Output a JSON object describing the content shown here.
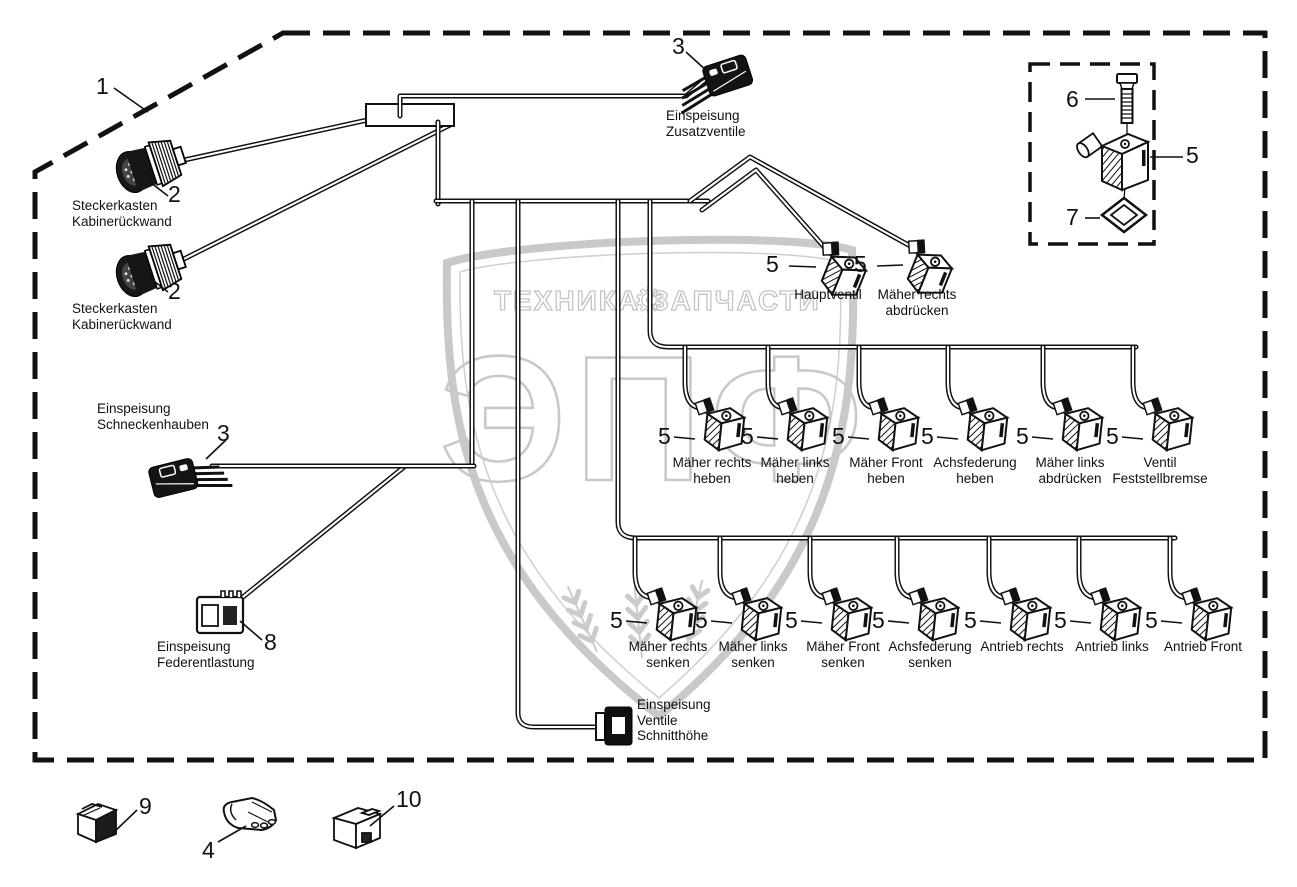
{
  "watermark": {
    "brand_left": "ТЕХНИКА",
    "brand_right": "ЗАПЧАСТИ",
    "gear_icon": "⚙",
    "monogram": "ЭПФ",
    "color": "#c9c9c9"
  },
  "callouts": {
    "harness": "1",
    "steckerkasten_a": "2",
    "steckerkasten_b": "2",
    "zusatzventile": "3",
    "schneckenhauben": "3",
    "part4": "4",
    "hauptventil": "5",
    "maeher_rechts_abdruecken": "5",
    "kit_screw": "6",
    "kit_valve": "5",
    "kit_seal": "7",
    "federentlastung": "8",
    "part9": "9",
    "part10": "10"
  },
  "labels": {
    "steckerkasten_a": [
      "Steckerkasten",
      "Kabinerückwand"
    ],
    "steckerkasten_b": [
      "Steckerkasten",
      "Kabinerückwand"
    ],
    "zusatzventile": [
      "Einspeisung",
      "Zusatzventile"
    ],
    "schneckenhauben": [
      "Einspeisung",
      "Schneckenhauben"
    ],
    "federentlastung": [
      "Einspeisung",
      "Federentlastung"
    ],
    "schnitthoehe": [
      "Einspeisung",
      "Ventile",
      "Schnitthöhe"
    ],
    "hauptventil": [
      "Hauptventil"
    ],
    "maeher_rechts_abdruecken": [
      "Mäher rechts",
      "abdrücken"
    ]
  },
  "mid_row": [
    {
      "callout": "5",
      "line1": "Mäher rechts",
      "line2": "heben"
    },
    {
      "callout": "5",
      "line1": "Mäher links",
      "line2": "heben"
    },
    {
      "callout": "5",
      "line1": "Mäher Front",
      "line2": "heben"
    },
    {
      "callout": "5",
      "line1": "Achsfederung",
      "line2": "heben"
    },
    {
      "callout": "5",
      "line1": "Mäher links",
      "line2": "abdrücken"
    },
    {
      "callout": "5",
      "line1": "Ventil",
      "line2": "Feststellbremse"
    }
  ],
  "bottom_row": [
    {
      "callout": "5",
      "line1": "Mäher rechts",
      "line2": "senken"
    },
    {
      "callout": "5",
      "line1": "Mäher links",
      "line2": "senken"
    },
    {
      "callout": "5",
      "line1": "Mäher Front",
      "line2": "senken"
    },
    {
      "callout": "5",
      "line1": "Achsfederung",
      "line2": "senken"
    },
    {
      "callout": "5",
      "line1": "Antrieb rechts",
      "line2": ""
    },
    {
      "callout": "5",
      "line1": "Antrieb links",
      "line2": ""
    },
    {
      "callout": "5",
      "line1": "Antrieb Front",
      "line2": ""
    }
  ]
}
